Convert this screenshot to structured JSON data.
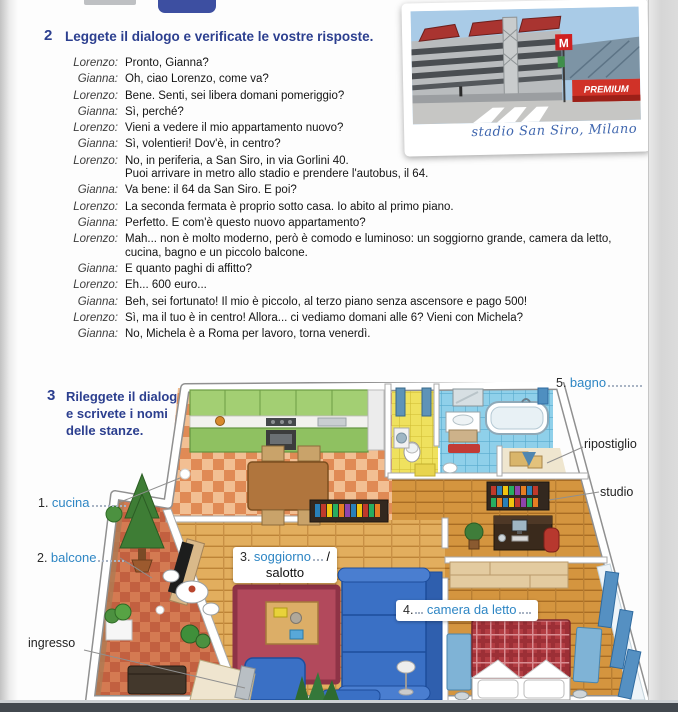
{
  "exercise2": {
    "number": "2",
    "title": "Leggete il dialogo e verificate le vostre risposte.",
    "dialogue": [
      {
        "speaker": "Lorenzo:",
        "text": "Pronto, Gianna?"
      },
      {
        "speaker": "Gianna:",
        "text": "Oh, ciao Lorenzo, come va?"
      },
      {
        "speaker": "Lorenzo:",
        "text": "Bene. Senti, sei libera domani pomeriggio?"
      },
      {
        "speaker": "Gianna:",
        "text": "Sì, perché?"
      },
      {
        "speaker": "Lorenzo:",
        "text": "Vieni a vedere il mio appartamento nuovo?"
      },
      {
        "speaker": "Gianna:",
        "text": "Sì, volentieri! Dov'è, in centro?"
      },
      {
        "speaker": "Lorenzo:",
        "text": "No, in periferia, a San Siro, in via Gorlini 40.\nPuoi arrivare in metro allo stadio e prendere l'autobus, il 64."
      },
      {
        "speaker": "Gianna:",
        "text": "Va bene: il 64 da San Siro. E poi?"
      },
      {
        "speaker": "Lorenzo:",
        "text": "La seconda fermata è proprio sotto casa. Io abito al primo piano."
      },
      {
        "speaker": "Gianna:",
        "text": "Perfetto. E com'è questo nuovo appartamento?"
      },
      {
        "speaker": "Lorenzo:",
        "text": "Mah... non è molto moderno, però è comodo e luminoso: un soggiorno grande, camera da letto, cucina, bagno e un piccolo balcone."
      },
      {
        "speaker": "Gianna:",
        "text": "E quanto paghi di affitto?"
      },
      {
        "speaker": "Lorenzo:",
        "text": "Eh... 600 euro..."
      },
      {
        "speaker": "Gianna:",
        "text": "Beh, sei fortunato! Il mio è piccolo, al terzo piano senza ascensore e pago 500!"
      },
      {
        "speaker": "Lorenzo:",
        "text": "Sì, ma il tuo è in centro! Allora... ci vediamo domani alle 6? Vieni con Michela?"
      },
      {
        "speaker": "Gianna:",
        "text": "No, Michela è a Roma per lavoro, torna venerdì."
      }
    ]
  },
  "photo": {
    "caption": "stadio San Siro, Milano",
    "premium_banner": "PREMIUM",
    "metro_sign": "M"
  },
  "exercise3": {
    "number": "3",
    "title": "Rileggete il dialogo\ne scrivete i nomi\ndelle stanze."
  },
  "plan_labels": {
    "cucina": {
      "num": "1.",
      "text": "cucina"
    },
    "balcone": {
      "num": "2.",
      "text": "balcone"
    },
    "soggiorno": {
      "num": "3.",
      "text": "soggiorno",
      "sep": "/",
      "alt": "salotto"
    },
    "camera": {
      "num": "4.",
      "text": "camera da letto"
    },
    "bagno": {
      "num": "5.",
      "text": "bagno"
    },
    "ripostiglio": "ripostiglio",
    "studio": "studio",
    "ingresso": "ingresso"
  },
  "colors": {
    "heading_blue": "#2c3f8f",
    "answer_blue": "#2e86c4",
    "kitchen_green": "#9ccb6a",
    "bathroom_blue": "#8fd0ea",
    "wc_yellow": "#efe15e",
    "sofa_blue": "#3a70c5",
    "rug_red": "#b2495c",
    "bed_plaid_red": "#b23c42",
    "wood_floor": "#e2ae5e",
    "balcony_tile": "#d47a52",
    "bottom_bar": "#42484f"
  }
}
